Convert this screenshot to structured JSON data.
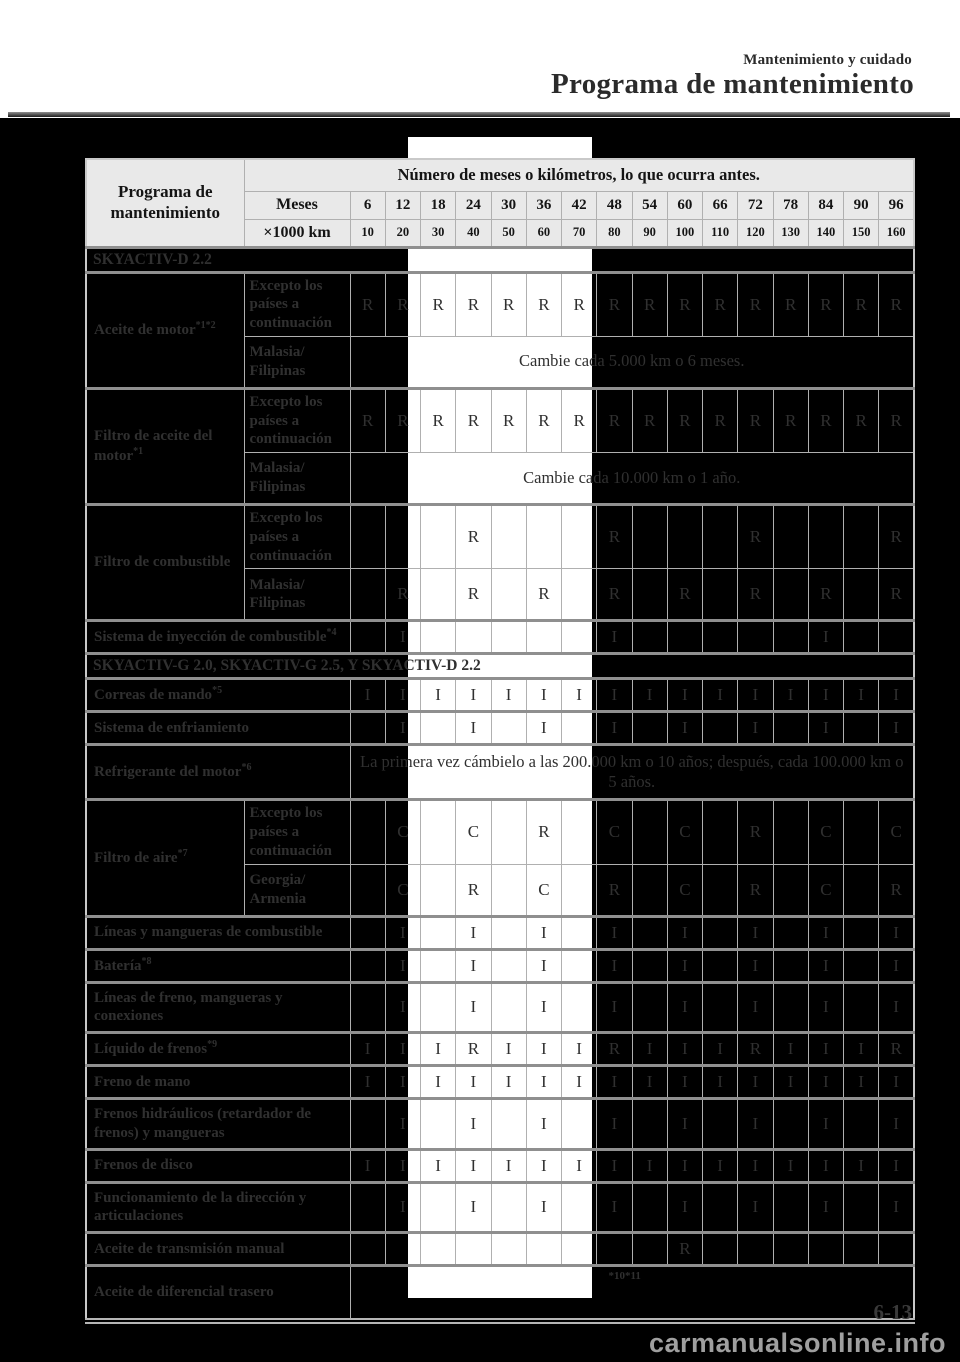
{
  "page_header": {
    "eyebrow": "Mantenimiento y cuidado",
    "title": "Programa de mantenimiento"
  },
  "table": {
    "corner_label": "Programa de mantenimiento",
    "span_header": "Número de meses o kilómetros, lo que ocurra antes.",
    "months_label": "Meses",
    "months": [
      "6",
      "12",
      "18",
      "24",
      "30",
      "36",
      "42",
      "48",
      "54",
      "60",
      "66",
      "72",
      "78",
      "84",
      "90",
      "96"
    ],
    "km_label": "×1000 km",
    "km": [
      "10",
      "20",
      "30",
      "40",
      "50",
      "60",
      "70",
      "80",
      "90",
      "100",
      "110",
      "120",
      "130",
      "140",
      "150",
      "160"
    ],
    "rows": [
      {
        "type": "section",
        "label": "SKYACTIV-D 2.2"
      },
      {
        "type": "group",
        "label": "Aceite de motor",
        "sup": "*1*2",
        "subs": [
          {
            "label": "Excepto los países a continuación",
            "cells": [
              "R",
              "R",
              "R",
              "R",
              "R",
              "R",
              "R",
              "R",
              "R",
              "R",
              "R",
              "R",
              "R",
              "R",
              "R",
              "R"
            ]
          },
          {
            "label": "Malasia/ Filipinas",
            "span": "Cambie cada 5.000 km o 6 meses."
          }
        ]
      },
      {
        "type": "group",
        "label": "Filtro de aceite del motor",
        "sup": "*1",
        "subs": [
          {
            "label": "Excepto los países a continuación",
            "cells": [
              "R",
              "R",
              "R",
              "R",
              "R",
              "R",
              "R",
              "R",
              "R",
              "R",
              "R",
              "R",
              "R",
              "R",
              "R",
              "R"
            ]
          },
          {
            "label": "Malasia/ Filipinas",
            "span": "Cambie cada 10.000 km o 1 año."
          }
        ]
      },
      {
        "type": "group",
        "label": "Filtro de combustible",
        "sup": "",
        "subs": [
          {
            "label": "Excepto los países a continuación",
            "cells": [
              "",
              "",
              "",
              "R",
              "",
              "",
              "",
              "R",
              "",
              "",
              "",
              "R",
              "",
              "",
              "",
              "R"
            ]
          },
          {
            "label": "Malasia/ Filipinas",
            "cells": [
              "",
              "R",
              "",
              "R",
              "",
              "R",
              "",
              "R",
              "",
              "R",
              "",
              "R",
              "",
              "R",
              "",
              "R"
            ]
          }
        ]
      },
      {
        "type": "simple",
        "label": "Sistema de inyección de combustible",
        "sup": "*4",
        "cells": [
          "",
          "I",
          "",
          "",
          "",
          "",
          "",
          "I",
          "",
          "",
          "",
          "",
          "",
          "I",
          "",
          ""
        ]
      },
      {
        "type": "section",
        "label": "SKYACTIV-G 2.0, SKYACTIV-G 2.5, Y SKYACTIV-D 2.2"
      },
      {
        "type": "simple",
        "label": "Correas de mando",
        "sup": "*5",
        "cells": [
          "I",
          "I",
          "I",
          "I",
          "I",
          "I",
          "I",
          "I",
          "I",
          "I",
          "I",
          "I",
          "I",
          "I",
          "I",
          "I"
        ]
      },
      {
        "type": "simple",
        "label": "Sistema de enfriamiento",
        "sup": "",
        "cells": [
          "",
          "I",
          "",
          "I",
          "",
          "I",
          "",
          "I",
          "",
          "I",
          "",
          "I",
          "",
          "I",
          "",
          "I"
        ]
      },
      {
        "type": "span",
        "label": "Refrigerante del motor",
        "sup": "*6",
        "span": "La primera vez cámbielo a las 200.000 km o 10 años; después, cada 100.000 km o 5 años."
      },
      {
        "type": "group",
        "label": "Filtro de aire",
        "sup": "*7",
        "subs": [
          {
            "label": "Excepto los países a continuación",
            "cells": [
              "",
              "C",
              "",
              "C",
              "",
              "R",
              "",
              "C",
              "",
              "C",
              "",
              "R",
              "",
              "C",
              "",
              "C"
            ]
          },
          {
            "label": "Georgia/ Armenia",
            "cells": [
              "",
              "C",
              "",
              "R",
              "",
              "C",
              "",
              "R",
              "",
              "C",
              "",
              "R",
              "",
              "C",
              "",
              "R"
            ]
          }
        ]
      },
      {
        "type": "simple",
        "label": "Líneas y mangueras de combustible",
        "sup": "",
        "cells": [
          "",
          "I",
          "",
          "I",
          "",
          "I",
          "",
          "I",
          "",
          "I",
          "",
          "I",
          "",
          "I",
          "",
          "I"
        ]
      },
      {
        "type": "simple",
        "label": "Batería",
        "sup": "*8",
        "cells": [
          "",
          "I",
          "",
          "I",
          "",
          "I",
          "",
          "I",
          "",
          "I",
          "",
          "I",
          "",
          "I",
          "",
          "I"
        ]
      },
      {
        "type": "simple",
        "label": "Líneas de freno, mangueras y conexiones",
        "sup": "",
        "cells": [
          "",
          "I",
          "",
          "I",
          "",
          "I",
          "",
          "I",
          "",
          "I",
          "",
          "I",
          "",
          "I",
          "",
          "I"
        ]
      },
      {
        "type": "simple",
        "label": "Líquido de frenos",
        "sup": "*9",
        "cells": [
          "I",
          "I",
          "I",
          "R",
          "I",
          "I",
          "I",
          "R",
          "I",
          "I",
          "I",
          "R",
          "I",
          "I",
          "I",
          "R"
        ]
      },
      {
        "type": "simple",
        "label": "Freno de mano",
        "sup": "",
        "cells": [
          "I",
          "I",
          "I",
          "I",
          "I",
          "I",
          "I",
          "I",
          "I",
          "I",
          "I",
          "I",
          "I",
          "I",
          "I",
          "I"
        ]
      },
      {
        "type": "simple",
        "label": "Frenos hidráulicos (retardador de frenos) y mangueras",
        "sup": "",
        "cells": [
          "",
          "I",
          "",
          "I",
          "",
          "I",
          "",
          "I",
          "",
          "I",
          "",
          "I",
          "",
          "I",
          "",
          "I"
        ]
      },
      {
        "type": "simple",
        "label": "Frenos de disco",
        "sup": "",
        "cells": [
          "I",
          "I",
          "I",
          "I",
          "I",
          "I",
          "I",
          "I",
          "I",
          "I",
          "I",
          "I",
          "I",
          "I",
          "I",
          "I"
        ]
      },
      {
        "type": "simple",
        "label": "Funcionamiento de la dirección y articulaciones",
        "sup": "",
        "cells": [
          "",
          "I",
          "",
          "I",
          "",
          "I",
          "",
          "I",
          "",
          "I",
          "",
          "I",
          "",
          "I",
          "",
          "I"
        ]
      },
      {
        "type": "simple",
        "label": "Aceite de transmisión manual",
        "sup": "",
        "cells": [
          "",
          "",
          "",
          "",
          "",
          "",
          "",
          "",
          "",
          "R",
          "",
          "",
          "",
          "",
          "",
          ""
        ]
      },
      {
        "type": "span",
        "label": "Aceite de diferencial trasero",
        "sup": "",
        "span": "*10*11",
        "small": true
      }
    ]
  },
  "footer": {
    "page_number": "6-13",
    "watermark": "carmanualsonline.info"
  }
}
